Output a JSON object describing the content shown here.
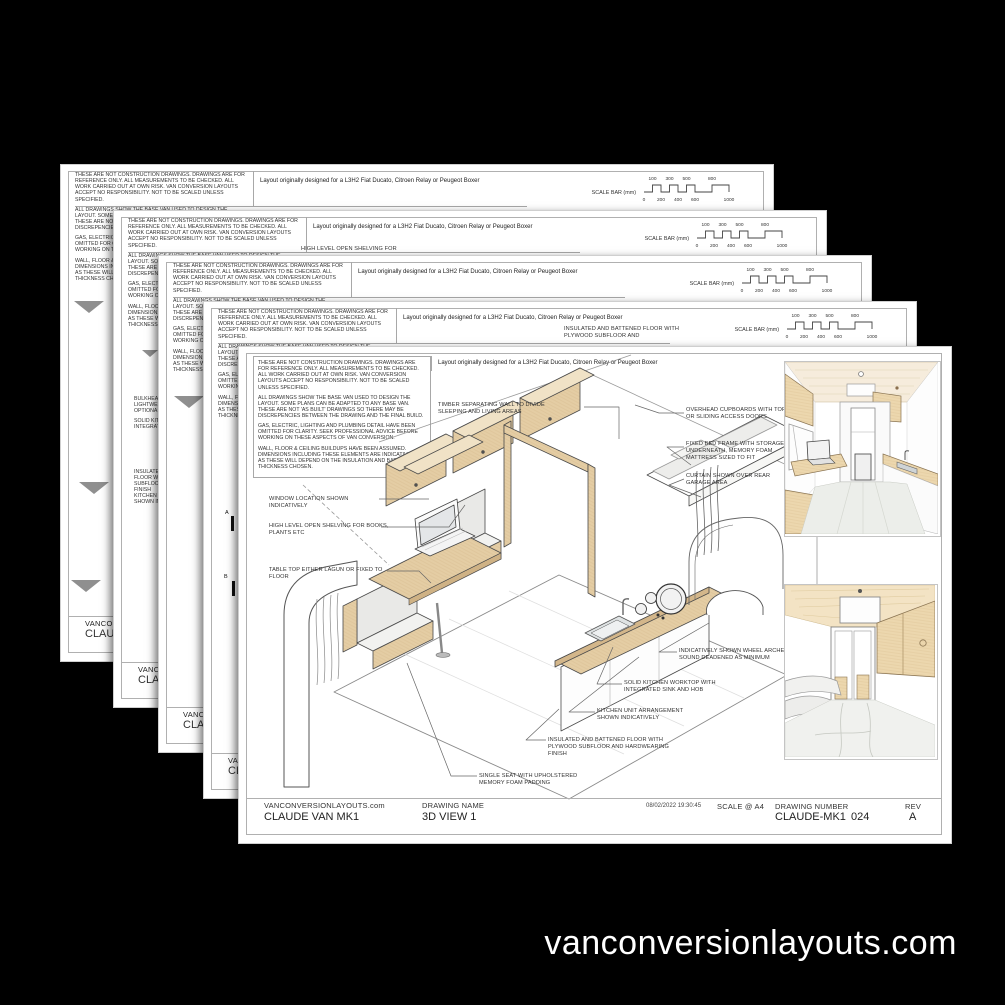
{
  "page": {
    "background": "#000000",
    "watermark": "vanconversionlayouts.com"
  },
  "colors": {
    "paper": "#ffffff",
    "wood": "#e4cda4",
    "wood_light": "#f0e2c6",
    "cushion": "#e9e9e7",
    "line": "#4a4a4a",
    "frame": "#b0b0b0"
  },
  "tpl": {
    "disclaimer": {
      "p1": "THESE ARE NOT CONSTRUCTION DRAWINGS. DRAWINGS ARE FOR REFERENCE ONLY. ALL MEASUREMENTS TO BE CHECKED. ALL WORK CARRIED OUT AT OWN RISK. VAN CONVERSION LAYOUTS ACCEPT NO RESPONSIBILITY. NOT TO BE SCALED UNLESS SPECIFIED.",
      "p2": "ALL DRAWINGS SHOW THE BASE VAN USED TO DESIGN THE LAYOUT. SOME PLANS CAN BE ADAPTED TO ANY BASE VAN. THESE ARE NOT 'AS BUILT' DRAWINGS SO THERE MAY BE DISCREPENCIES BETWEEN THE DRAWING AND THE FINAL BUILD.",
      "p3": "GAS, ELECTRIC, LIGHTING AND PLUMBING DETAIL HAVE BEEN OMITTED FOR CLARITY. SEEK PROFESSIONAL ADVICE BEFORE WORKING ON THESE ASPECTS OF VAN CONVERSION.",
      "p4": "WALL, FLOOR & CEILING BUILDUPS HAVE BEEN ASSUMED. DIMENSIONS INCLUDING THESE ELEMENTS ARE INDICATIVE ONLY AS THESE WILL DEPEND ON THE INSULATION AND BATTEN THICKNESS CHOSEN."
    },
    "layout_note": "Layout originally designed for a L3H2 Fiat Ducato, Citroen Relay or Peugeot Boxer",
    "scale_bar": {
      "label": "SCALE BAR (mm)",
      "top_ticks": [
        "100",
        "300",
        "500",
        "800"
      ],
      "bottom_ticks": [
        "0",
        "200",
        "400",
        "600",
        "1000"
      ]
    },
    "footer_site": "VANCONVERSIONLAYOUTS.com",
    "footer_project": "CLAUDE VAN MK1"
  },
  "front": {
    "title_block": {
      "site": "VANCONVERSIONLAYOUTS.com",
      "project": "CLAUDE VAN MK1",
      "drawing_name_label": "DRAWING NAME",
      "drawing_name": "3D VIEW 1",
      "timestamp": "08/02/2022 19:30:45",
      "scale_label": "SCALE @ A4",
      "drawing_number_label": "DRAWING NUMBER",
      "drawing_number": "CLAUDE-MK1",
      "page_number": "024",
      "rev_label": "REV",
      "rev": "A"
    },
    "annotations": {
      "timber": "TIMBER SEPARATING WALL TO DIVIDE SLEEPING AND LIVING AREAS",
      "overhead": "OVERHEAD CUPBOARDS WITH TOP HUNG OR SLIDING ACCESS DOORS",
      "bed": "FIXED BED FRAME WITH STORAGE UNDERNEATH, MEMORY FOAM MATTRESS SIZED TO FIT",
      "curtain": "CURTAIN SHOWN OVER REAR GARAGE AREA",
      "window": "WINDOW LOCATION SHOWN INDICATIVELY",
      "shelving": "HIGH LEVEL OPEN SHELVING FOR BOOKS, PLANTS ETC",
      "table": "TABLE TOP EITHER LAGUN OR FIXED TO FLOOR",
      "wheel": "INDICATIVELY SHOWN WHEEL ARCHES TO BE SOUND DEADENED AS MINIMUM",
      "worktop": "SOLID KITCHEN WORKTOP WITH INTEGRATED SINK AND HOB",
      "kitchen_unit": "KITCHEN UNIT ARRANGEMENT SHOWN INDICATIVELY",
      "floor": "INSULATED AND BATTENED FLOOR WITH PLYWOOD SUBFLOOR AND HARDWEARING FINISH",
      "seat": "SINGLE SEAT WITH UPHOLSTERED MEMORY FOAM PADDING"
    }
  },
  "fragments": {
    "sheet2_shelving": "HIGH LEVEL OPEN SHELVING FOR",
    "sheet2_bulkhead": "BULKHEA\nLIGHTWEI\nOPTIONA",
    "sheet4_floor": "INSULATED AND BATTENED FLOOR WITH PLYWOOD SUBFLOOR AND",
    "marker_a": "A",
    "marker_b": "B"
  }
}
